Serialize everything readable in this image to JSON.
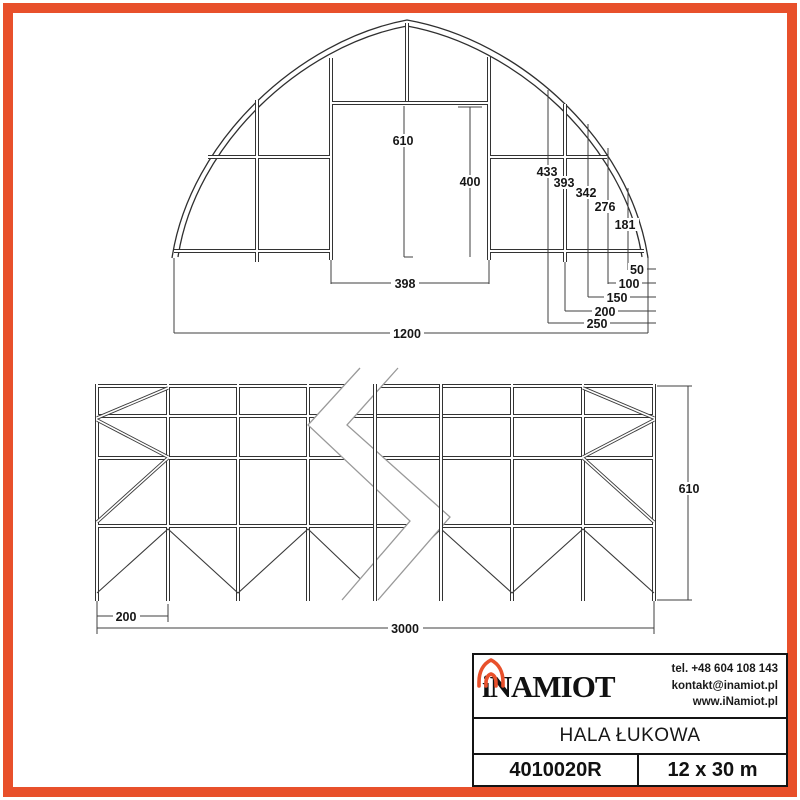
{
  "colors": {
    "accent": "#E8502B",
    "line": "#333333"
  },
  "front_elevation": {
    "dim_apex_height": "610",
    "dim_door_height": "400",
    "dim_door_width": "398",
    "dim_total_width": "1200",
    "dim_h_433": "433",
    "dim_h_393": "393",
    "dim_h_342": "342",
    "dim_h_276": "276",
    "dim_h_181": "181",
    "dim_off_50": "50",
    "dim_off_100": "100",
    "dim_off_150": "150",
    "dim_off_200": "200",
    "dim_off_250": "250"
  },
  "side_elevation": {
    "dim_bay_width": "200",
    "dim_total_length": "3000",
    "dim_height": "610"
  },
  "title_block": {
    "brand": "iNAMIOT",
    "contact": {
      "phone": "tel. +48 604 108 143",
      "email": "kontakt@inamiot.pl",
      "website": "www.iNamiot.pl"
    },
    "product_name": "HALA ŁUKOWA",
    "model_number": "4010020R",
    "dimensions": "12 x 30 m"
  }
}
